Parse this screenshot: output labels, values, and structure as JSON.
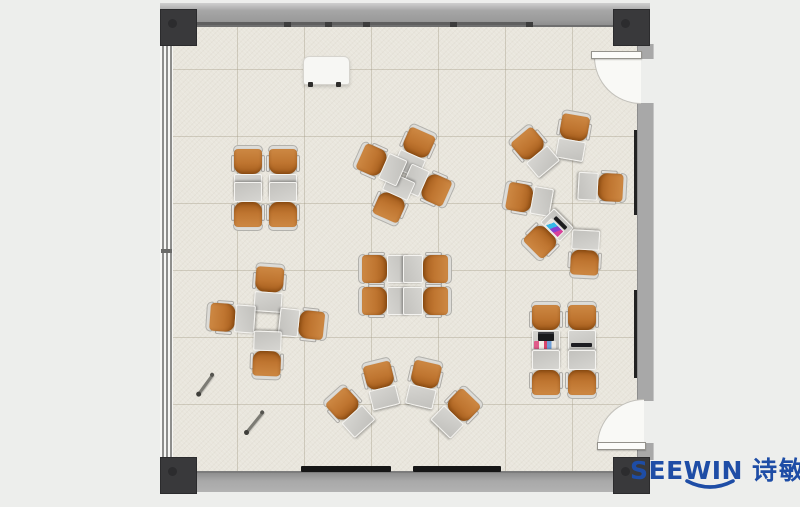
{
  "brand": {
    "en": "SEEWIN",
    "cjk": "诗敏",
    "color": "#1e4da6"
  },
  "palette": {
    "canvas": "#edeeec",
    "floor": "#e9e6dd",
    "tile_grid": "#d9d5c9",
    "wall": "#a8a8a8",
    "wall_edge": "#6f6f6f",
    "corner_post": "#39393b",
    "chair_orange": "#bf7530",
    "chair_back": "#dddcd8",
    "desk_gray": "#c8c7c3",
    "desk_trim": "#f4f3f0",
    "heater_black": "#161616",
    "door_white": "#f9f9f6"
  },
  "room": {
    "floor": {
      "x": 171,
      "y": 25,
      "w": 467,
      "h": 446,
      "tile_px": 67
    },
    "doors": [
      {
        "side": "right",
        "position": "top",
        "hinge": "north",
        "open_deg": 90
      },
      {
        "side": "right",
        "position": "bottom",
        "hinge": "south",
        "open_deg": 90
      }
    ],
    "corner_posts": 4,
    "window_wall": "left",
    "whiteboard": {
      "x": 303,
      "y": 56,
      "w": 45,
      "h": 27
    }
  },
  "furniture": {
    "unit_type": "tablet-arm training chair with desk",
    "units": [
      {
        "x": 248,
        "y": 170,
        "rot": 0
      },
      {
        "x": 283,
        "y": 170,
        "rot": 0
      },
      {
        "x": 248,
        "y": 206,
        "rot": 180
      },
      {
        "x": 283,
        "y": 206,
        "rot": 180
      },
      {
        "x": 415,
        "y": 151,
        "rot": 24
      },
      {
        "x": 428,
        "y": 186,
        "rot": 114
      },
      {
        "x": 393,
        "y": 199,
        "rot": 204
      },
      {
        "x": 380,
        "y": 164,
        "rot": -66
      },
      {
        "x": 573,
        "y": 136,
        "rot": 10
      },
      {
        "x": 534,
        "y": 151,
        "rot": -40
      },
      {
        "x": 528,
        "y": 199,
        "rot": -80
      },
      {
        "x": 547,
        "y": 235,
        "rot": -135,
        "item": "magazine"
      },
      {
        "x": 602,
        "y": 187,
        "rot": 93
      },
      {
        "x": 585,
        "y": 254,
        "rot": 183
      },
      {
        "x": 269,
        "y": 288,
        "rot": 4
      },
      {
        "x": 231,
        "y": 318,
        "rot": -86
      },
      {
        "x": 303,
        "y": 324,
        "rot": 96
      },
      {
        "x": 267,
        "y": 355,
        "rot": 182
      },
      {
        "x": 383,
        "y": 269,
        "rot": -90
      },
      {
        "x": 427,
        "y": 269,
        "rot": 90
      },
      {
        "x": 383,
        "y": 301,
        "rot": -90
      },
      {
        "x": 427,
        "y": 301,
        "rot": 90
      },
      {
        "x": 349,
        "y": 411,
        "rot": -42
      },
      {
        "x": 381,
        "y": 384,
        "rot": -14
      },
      {
        "x": 424,
        "y": 383,
        "rot": 13
      },
      {
        "x": 457,
        "y": 412,
        "rot": 44
      },
      {
        "x": 546,
        "y": 326,
        "rot": 0,
        "item": "laptop"
      },
      {
        "x": 582,
        "y": 326,
        "rot": 0,
        "item": "tablet"
      },
      {
        "x": 546,
        "y": 374,
        "rot": 180
      },
      {
        "x": 582,
        "y": 374,
        "rot": 180
      }
    ],
    "pens": [
      {
        "x": 205,
        "y": 383,
        "len": 25,
        "rot": -54
      },
      {
        "x": 254,
        "y": 421,
        "len": 27,
        "rot": -51
      }
    ]
  }
}
